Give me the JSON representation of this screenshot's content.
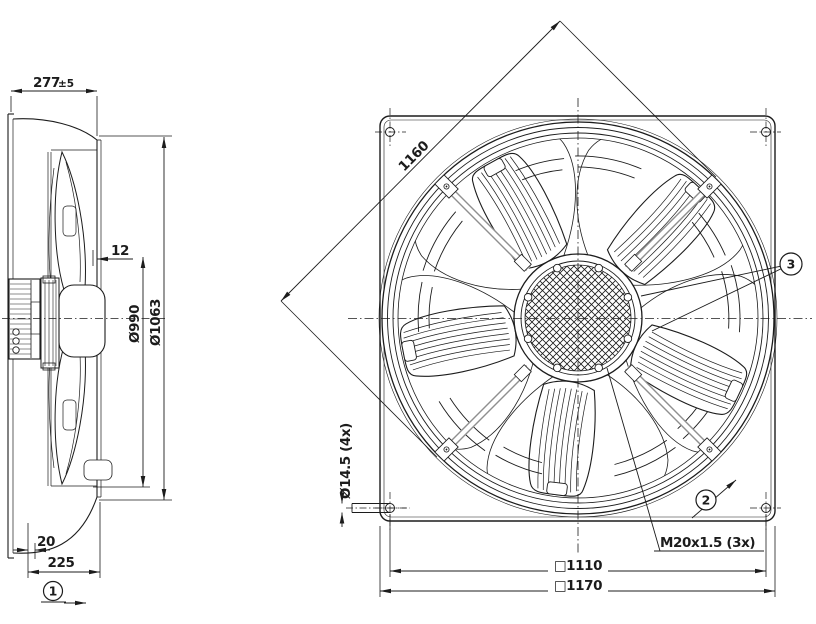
{
  "drawing": {
    "side_view": {
      "depth": "277",
      "depth_tolerance": "±5",
      "tip_gap": "12",
      "impeller_diameter": "Ø990",
      "housing_diameter": "Ø1063",
      "flange_offset": "20",
      "mounting_depth": "225",
      "airflow_callout": "1"
    },
    "front_view": {
      "diagonal": "1160",
      "corner_hole": "Ø14.5 (4x)",
      "cable_gland": "M20x1.5 (3x)",
      "hole_pitch": "□1110",
      "frame_size": "□1170",
      "guard_callout": "2",
      "hub_callout": "3"
    },
    "colors": {
      "line": "#1c1c1c",
      "strut": "#8f8f8f",
      "background": "#ffffff"
    }
  }
}
